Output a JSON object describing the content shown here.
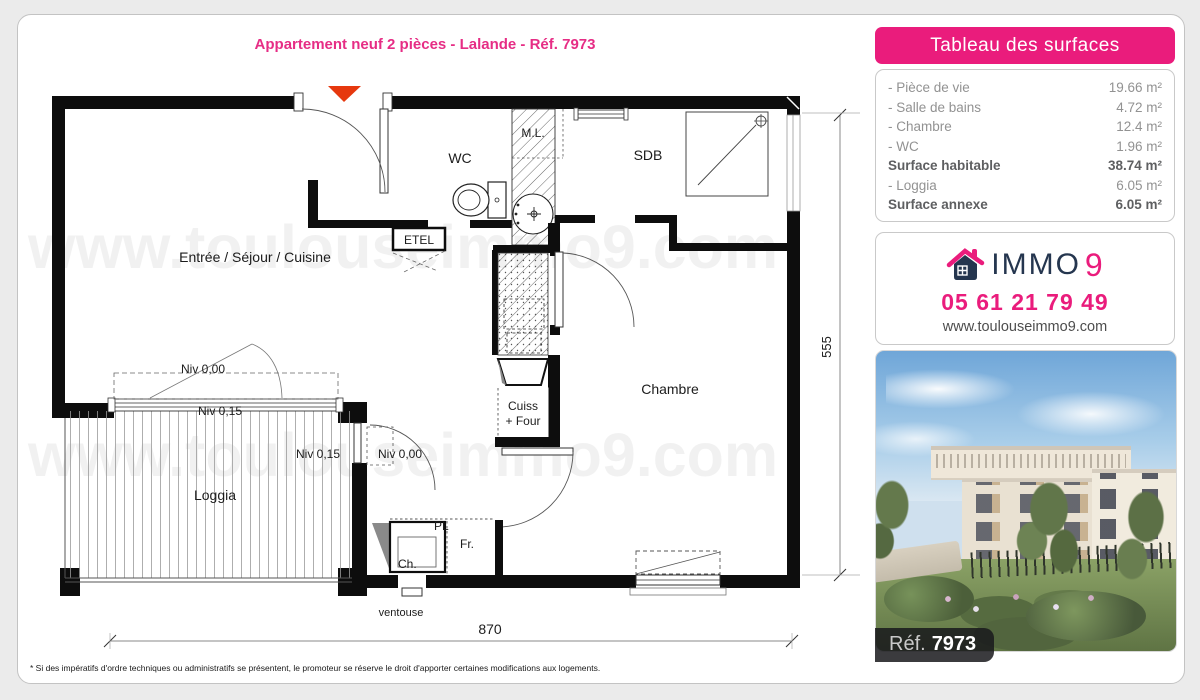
{
  "title": "Appartement neuf 2 pièces - Lalande - Réf. 7973",
  "watermark": "www.toulouseimmo9.com",
  "colors": {
    "pink": "#e8217c",
    "navy": "#25364f",
    "arrow_red": "#e6380e"
  },
  "surfaces": {
    "header": "Tableau des surfaces",
    "rows": [
      {
        "label": "- Pièce de vie",
        "value": "19.66 m²"
      },
      {
        "label": "- Salle de bains",
        "value": "4.72 m²"
      },
      {
        "label": "- Chambre",
        "value": "12.4 m²"
      },
      {
        "label": "- WC",
        "value": "1.96 m²"
      },
      {
        "label": "Surface habitable",
        "value": "38.74 m²"
      },
      {
        "label": "- Loggia",
        "value": "6.05 m²"
      },
      {
        "label": "Surface annexe",
        "value": "6.05 m²"
      }
    ]
  },
  "agency": {
    "brand_word": "IMMO",
    "brand_nine": "9",
    "phone": "05 61 21 79 49",
    "website": "www.toulouseimmo9.com"
  },
  "photo": {
    "ref_label": "Réf.",
    "ref_value": "7973"
  },
  "plan": {
    "labels": {
      "entree": "Entrée / Séjour / Cuisine",
      "wc": "WC",
      "ml": "M.L.",
      "sdb": "SDB",
      "etel": "ETEL",
      "chambre": "Chambre",
      "cuiss_line1": "Cuiss",
      "cuiss_line2": "+ Four",
      "loggia": "Loggia",
      "niv_000": "Niv 0,00",
      "niv_015": "Niv 0,15",
      "pl": "PL",
      "fr": "Fr.",
      "ch": "Ch.",
      "ventouse": "ventouse"
    },
    "dimensions": {
      "width": "870",
      "height": "555"
    }
  },
  "footnote": "* Si des impératifs d'ordre techniques ou administratifs se présentent, le promoteur se réserve le droit d'apporter certaines modifications aux logements."
}
